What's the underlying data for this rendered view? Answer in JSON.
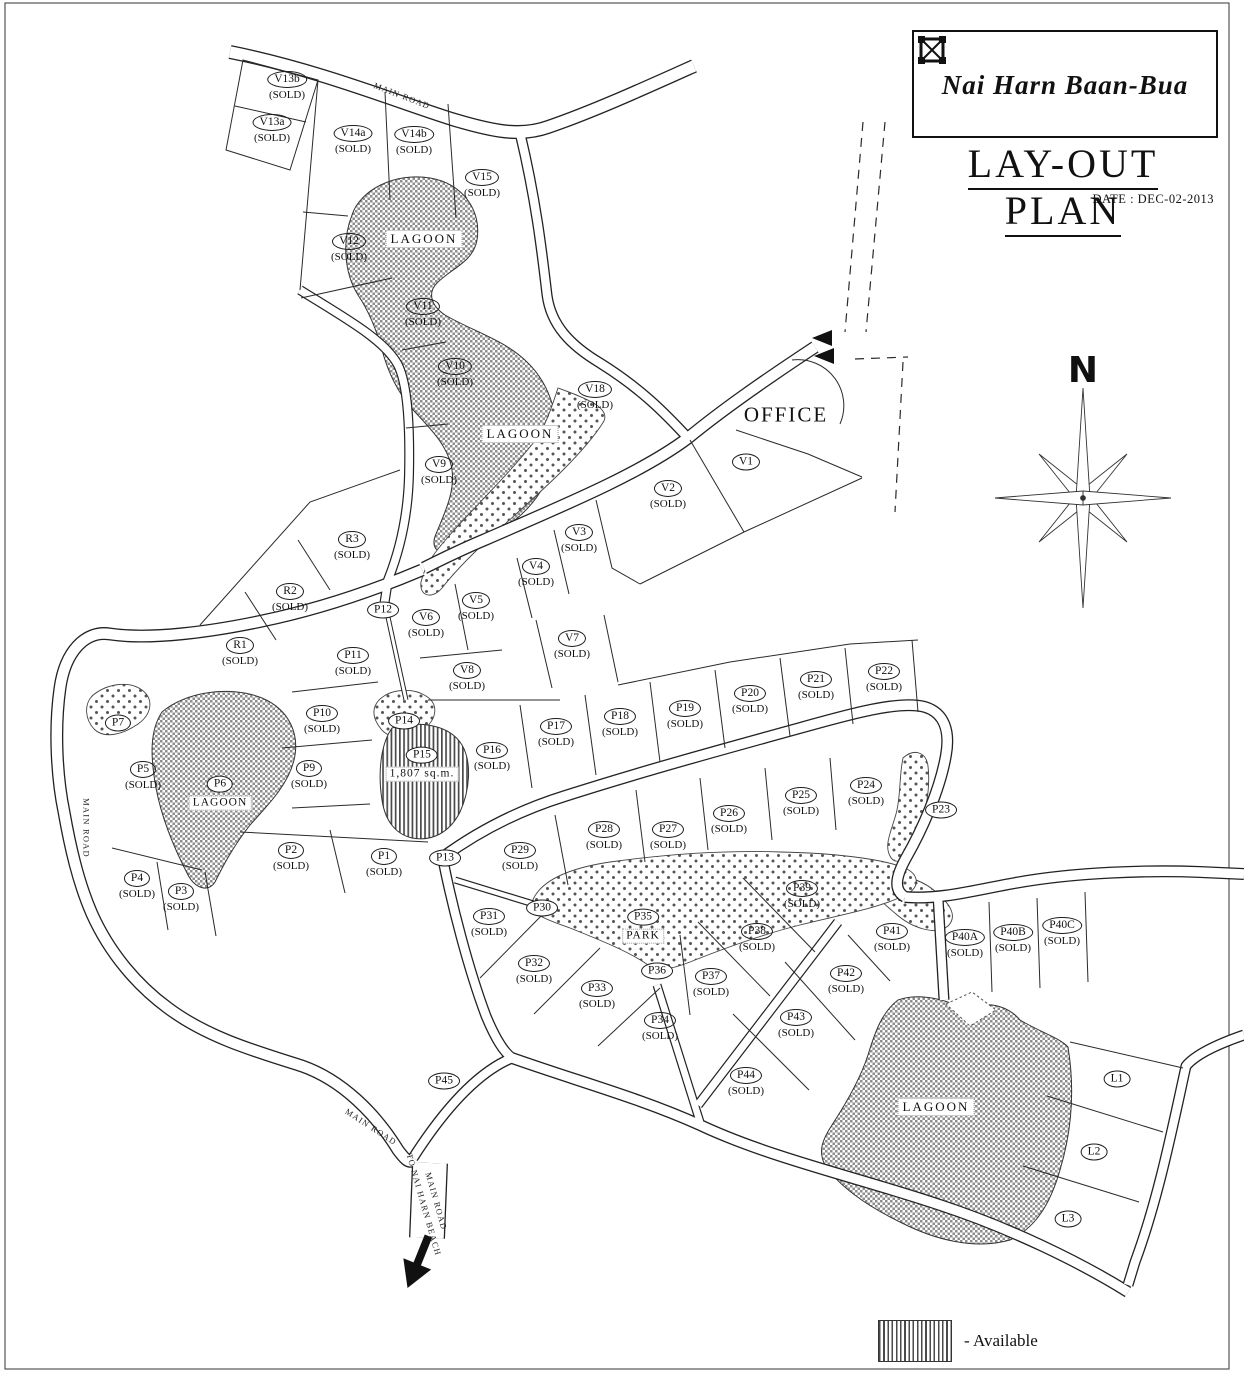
{
  "colors": {
    "ink": "#1d1d1d",
    "paper": "#ffffff"
  },
  "header": {
    "brand": "Nai Harn Baan-Bua",
    "title": "LAY-OUT PLAN",
    "date_label": "DATE : DEC-02-2013"
  },
  "compass": {
    "north_label": "N"
  },
  "legend": {
    "available_label": "- Available"
  },
  "map": {
    "office_label": "OFFICE",
    "road_labels": [
      {
        "lines": [
          "MAIN ROAD"
        ],
        "x": 402,
        "y": 96,
        "rot": 21
      },
      {
        "lines": [
          "MAIN ROAD"
        ],
        "x": 86,
        "y": 828,
        "rot": 90
      },
      {
        "lines": [
          "MAIN ROAD"
        ],
        "x": 371,
        "y": 1127,
        "rot": 33
      },
      {
        "lines": [
          "MAIN ROAD",
          "TO NAI HARN BEACH"
        ],
        "x": 430,
        "y": 1203,
        "rot": 74
      }
    ],
    "area_labels": [
      {
        "text": "LAGOON",
        "x": 424,
        "y": 239
      },
      {
        "text": "LAGOON",
        "x": 520,
        "y": 434
      },
      {
        "text": "LAGOON",
        "x": 936,
        "y": 1107
      }
    ],
    "plots": [
      {
        "id": "V13b",
        "status": "(SOLD)",
        "x": 287,
        "y": 85
      },
      {
        "id": "V13a",
        "status": "(SOLD)",
        "x": 272,
        "y": 128
      },
      {
        "id": "V14a",
        "status": "(SOLD)",
        "x": 353,
        "y": 139
      },
      {
        "id": "V14b",
        "status": "(SOLD)",
        "x": 414,
        "y": 140
      },
      {
        "id": "V15",
        "status": "(SOLD)",
        "x": 482,
        "y": 183
      },
      {
        "id": "V12",
        "status": "(SOLD)",
        "x": 349,
        "y": 247
      },
      {
        "id": "V11",
        "status": "(SOLD)",
        "x": 423,
        "y": 312
      },
      {
        "id": "V10",
        "status": "(SOLD)",
        "x": 455,
        "y": 372
      },
      {
        "id": "V18",
        "status": "(SOLD)",
        "x": 595,
        "y": 395
      },
      {
        "id": "V9",
        "status": "(SOLD)",
        "x": 439,
        "y": 470
      },
      {
        "id": "V1",
        "x": 746,
        "y": 461
      },
      {
        "id": "V2",
        "status": "(SOLD)",
        "x": 668,
        "y": 494
      },
      {
        "id": "V3",
        "status": "(SOLD)",
        "x": 579,
        "y": 538
      },
      {
        "id": "V4",
        "status": "(SOLD)",
        "x": 536,
        "y": 572
      },
      {
        "id": "V5",
        "status": "(SOLD)",
        "x": 476,
        "y": 606
      },
      {
        "id": "V6",
        "status": "(SOLD)",
        "x": 426,
        "y": 623
      },
      {
        "id": "V7",
        "status": "(SOLD)",
        "x": 572,
        "y": 644
      },
      {
        "id": "V8",
        "status": "(SOLD)",
        "x": 467,
        "y": 676
      },
      {
        "id": "R3",
        "status": "(SOLD)",
        "x": 352,
        "y": 545
      },
      {
        "id": "R2",
        "status": "(SOLD)",
        "x": 290,
        "y": 597
      },
      {
        "id": "R1",
        "status": "(SOLD)",
        "x": 240,
        "y": 651
      },
      {
        "id": "P12",
        "x": 383,
        "y": 609,
        "bg": true
      },
      {
        "id": "P11",
        "status": "(SOLD)",
        "x": 353,
        "y": 661
      },
      {
        "id": "P10",
        "status": "(SOLD)",
        "x": 322,
        "y": 719
      },
      {
        "id": "P14",
        "x": 404,
        "y": 720,
        "bg": true
      },
      {
        "id": "P7",
        "x": 118,
        "y": 722,
        "bg": true
      },
      {
        "id": "P5",
        "status": "(SOLD)",
        "x": 143,
        "y": 775
      },
      {
        "id": "P6",
        "area": "LAGOON",
        "x": 220,
        "y": 792,
        "bg": true
      },
      {
        "id": "P9",
        "status": "(SOLD)",
        "x": 309,
        "y": 774
      },
      {
        "id": "P15",
        "area": "1,807 sq.m.",
        "x": 422,
        "y": 763,
        "bg": true
      },
      {
        "id": "P16",
        "status": "(SOLD)",
        "x": 492,
        "y": 756
      },
      {
        "id": "P17",
        "status": "(SOLD)",
        "x": 556,
        "y": 732
      },
      {
        "id": "P18",
        "status": "(SOLD)",
        "x": 620,
        "y": 722
      },
      {
        "id": "P19",
        "status": "(SOLD)",
        "x": 685,
        "y": 714
      },
      {
        "id": "P20",
        "status": "(SOLD)",
        "x": 750,
        "y": 699
      },
      {
        "id": "P21",
        "status": "(SOLD)",
        "x": 816,
        "y": 685
      },
      {
        "id": "P22",
        "status": "(SOLD)",
        "x": 884,
        "y": 677
      },
      {
        "id": "P23",
        "x": 941,
        "y": 809,
        "bg": true
      },
      {
        "id": "P24",
        "status": "(SOLD)",
        "x": 866,
        "y": 791
      },
      {
        "id": "P25",
        "status": "(SOLD)",
        "x": 801,
        "y": 801
      },
      {
        "id": "P26",
        "status": "(SOLD)",
        "x": 729,
        "y": 819
      },
      {
        "id": "P27",
        "status": "(SOLD)",
        "x": 668,
        "y": 835
      },
      {
        "id": "P28",
        "status": "(SOLD)",
        "x": 604,
        "y": 835
      },
      {
        "id": "P29",
        "status": "(SOLD)",
        "x": 520,
        "y": 856
      },
      {
        "id": "P13",
        "x": 445,
        "y": 857,
        "bg": true
      },
      {
        "id": "P2",
        "status": "(SOLD)",
        "x": 291,
        "y": 856
      },
      {
        "id": "P1",
        "status": "(SOLD)",
        "x": 384,
        "y": 862
      },
      {
        "id": "P4",
        "status": "(SOLD)",
        "x": 137,
        "y": 884
      },
      {
        "id": "P3",
        "status": "(SOLD)",
        "x": 181,
        "y": 897
      },
      {
        "id": "P30",
        "x": 542,
        "y": 907,
        "bg": true
      },
      {
        "id": "P31",
        "status": "(SOLD)",
        "x": 489,
        "y": 922
      },
      {
        "id": "P35",
        "area": "PARK",
        "x": 643,
        "y": 925,
        "bg": true
      },
      {
        "id": "P32",
        "status": "(SOLD)",
        "x": 534,
        "y": 969
      },
      {
        "id": "P33",
        "status": "(SOLD)",
        "x": 597,
        "y": 994
      },
      {
        "id": "P36",
        "x": 657,
        "y": 970,
        "bg": true
      },
      {
        "id": "P37",
        "status": "(SOLD)",
        "x": 711,
        "y": 982
      },
      {
        "id": "P38",
        "status": "(SOLD)",
        "x": 757,
        "y": 937
      },
      {
        "id": "P39",
        "status": "(SOLD)",
        "x": 802,
        "y": 894
      },
      {
        "id": "P34",
        "status": "(SOLD)",
        "x": 660,
        "y": 1026
      },
      {
        "id": "P41",
        "status": "(SOLD)",
        "x": 892,
        "y": 937
      },
      {
        "id": "P40A",
        "status": "(SOLD)",
        "x": 965,
        "y": 943
      },
      {
        "id": "P40B",
        "status": "(SOLD)",
        "x": 1013,
        "y": 938
      },
      {
        "id": "P40C",
        "status": "(SOLD)",
        "x": 1062,
        "y": 931
      },
      {
        "id": "P42",
        "status": "(SOLD)",
        "x": 846,
        "y": 979
      },
      {
        "id": "P43",
        "status": "(SOLD)",
        "x": 796,
        "y": 1023
      },
      {
        "id": "P44",
        "status": "(SOLD)",
        "x": 746,
        "y": 1081
      },
      {
        "id": "P45",
        "x": 444,
        "y": 1080
      },
      {
        "id": "L1",
        "x": 1117,
        "y": 1078
      },
      {
        "id": "L2",
        "x": 1094,
        "y": 1151
      },
      {
        "id": "L3",
        "x": 1068,
        "y": 1218
      }
    ]
  }
}
